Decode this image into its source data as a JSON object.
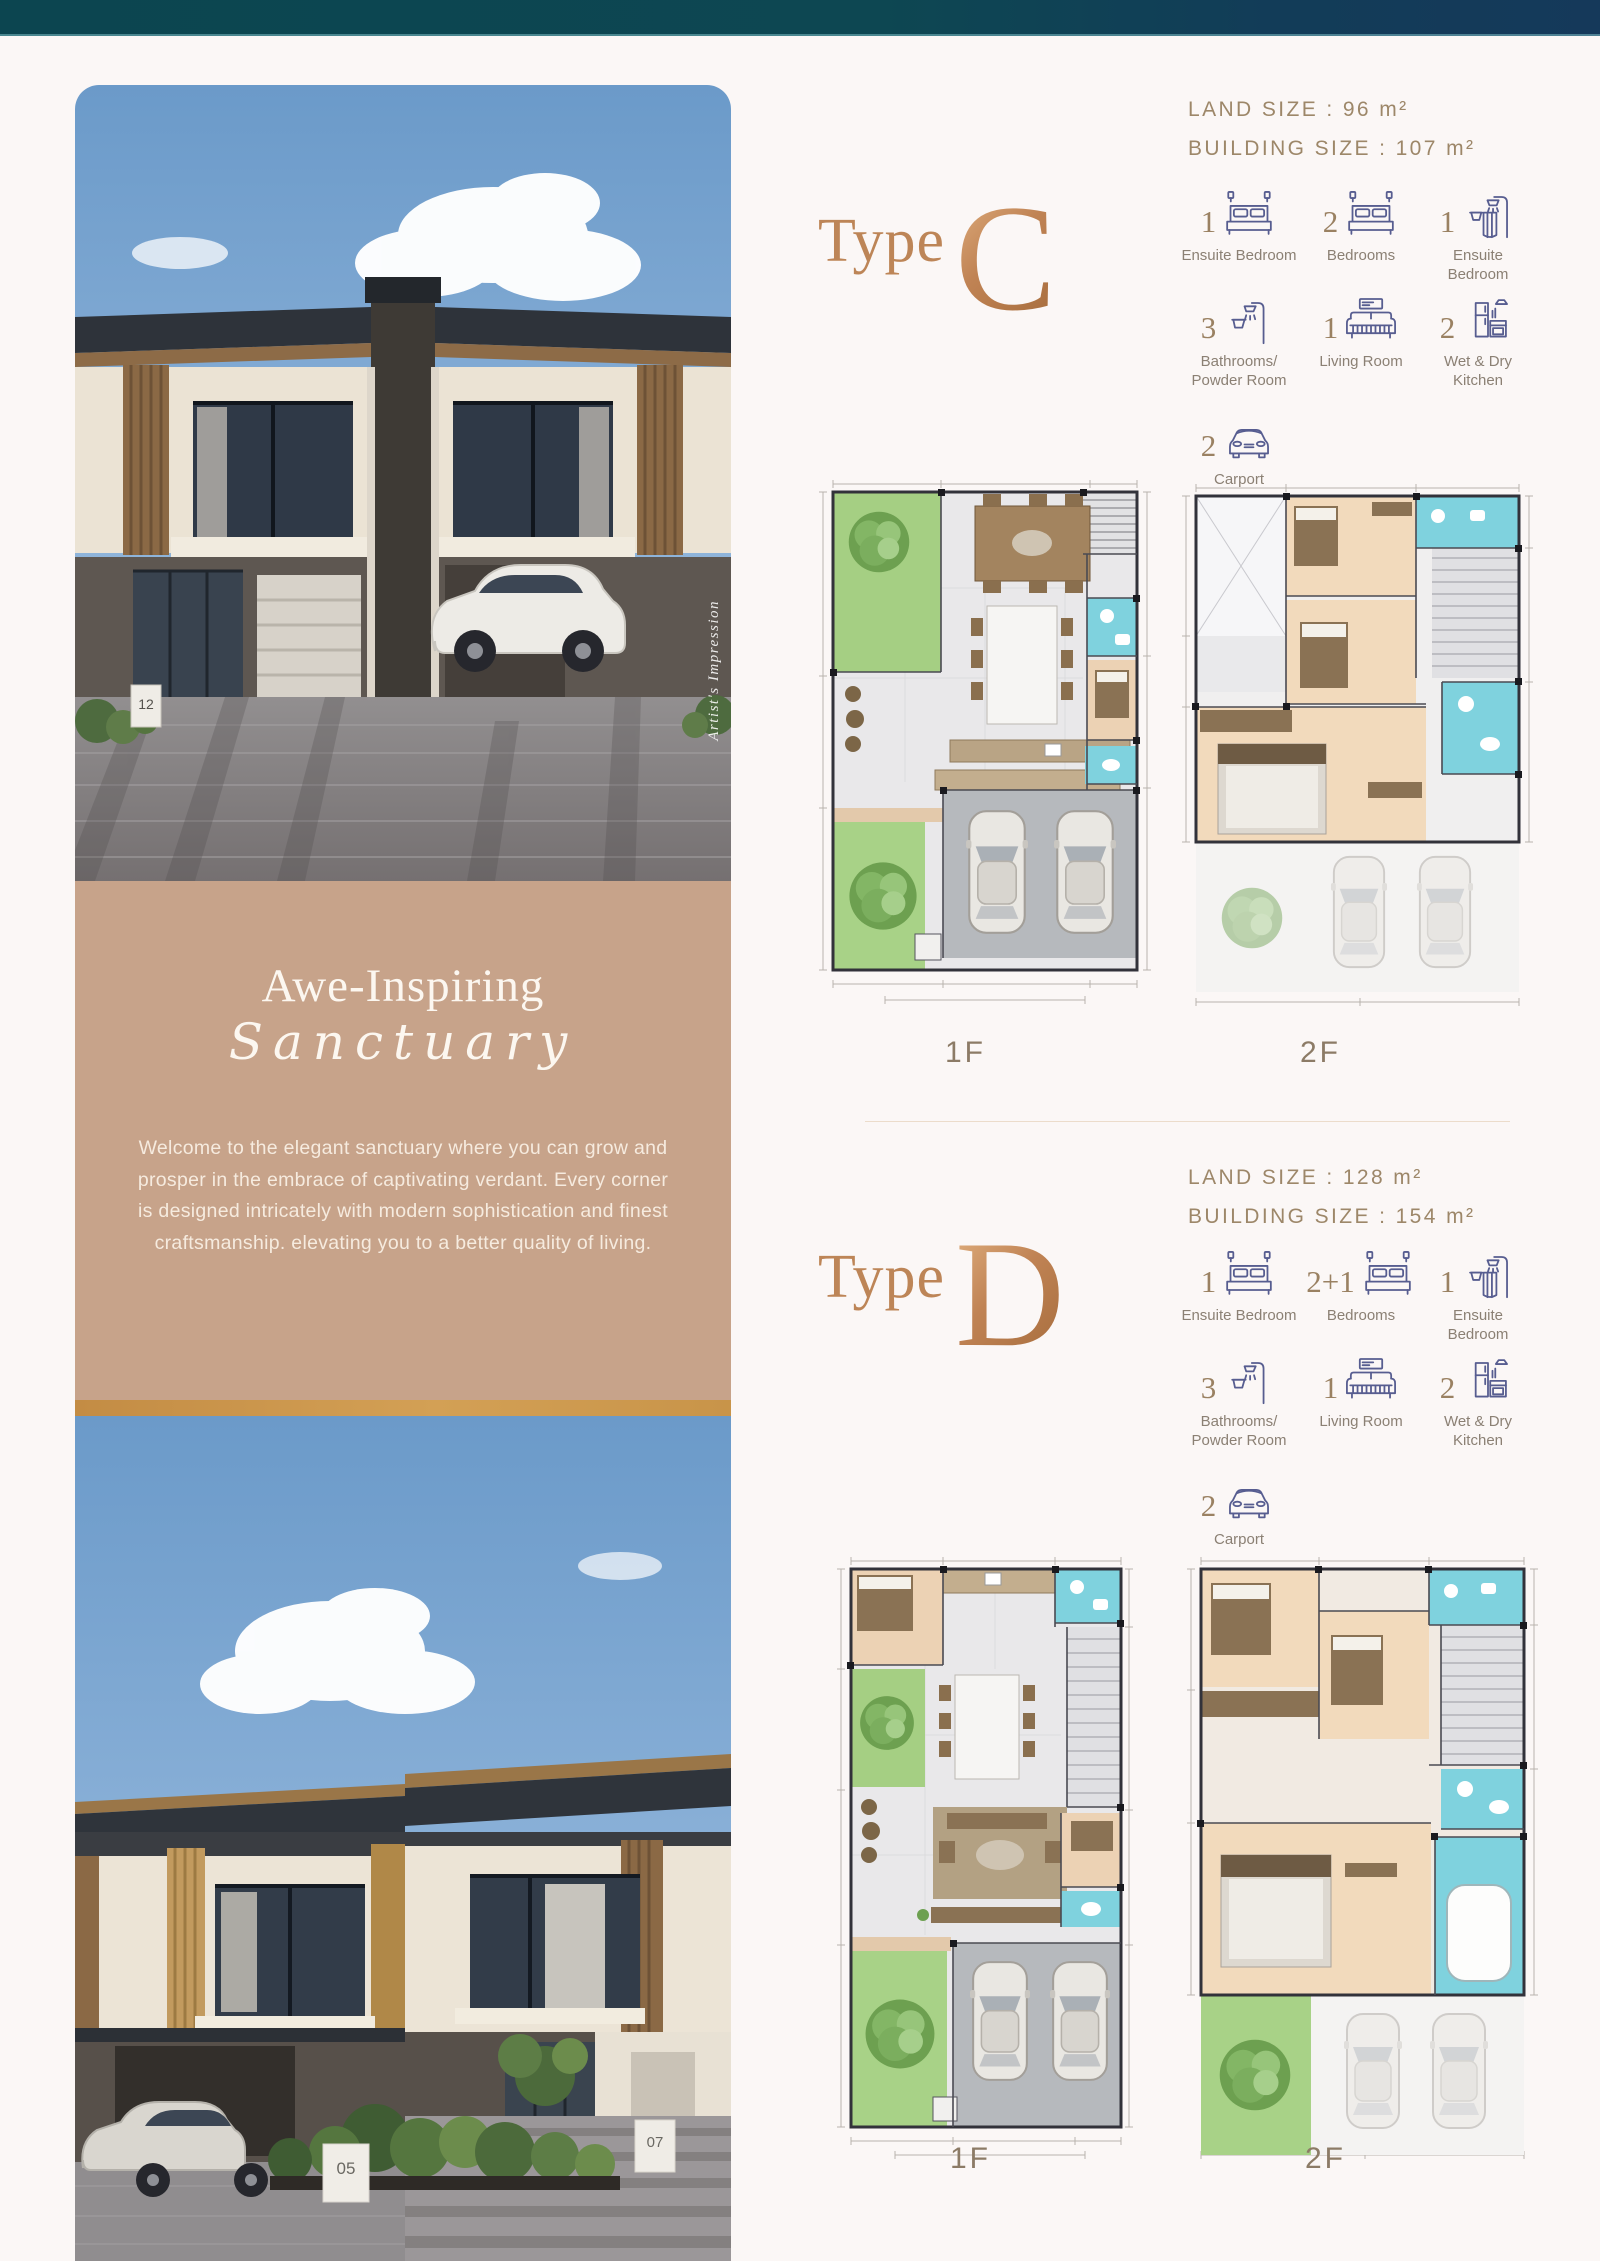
{
  "colors": {
    "top_bar_teal": "#0c4550",
    "top_bar_navy": "#15395a",
    "tan_panel": "#c7a38a",
    "copper_accent": "#c08354",
    "spec_text_taupe": "#9d8769",
    "icon_navy": "#575d90",
    "plan_bathroom_cyan": "#7fd2de",
    "plan_garden_green": "#a5cf83"
  },
  "photos": {
    "artists_impression": "Artist's Impression",
    "top_house_sign": "12",
    "bottom_house_sign_left": "05",
    "bottom_house_sign_right": "07"
  },
  "sanctuary": {
    "title": "Awe-Inspiring",
    "subtitle": "Sanctuary",
    "description": "Welcome to the elegant sanctuary where you can grow and prosper in the embrace of captivating verdant. Every corner is designed intricately with modern sophistication and finest craftsmanship. elevating you to a better quality of living."
  },
  "type_c": {
    "word": "Type",
    "letter": "C",
    "land_size": "LAND SIZE : 96 m²",
    "building_size": "BUILDING SIZE : 107 m²",
    "features": [
      {
        "count": "1",
        "label": "Ensuite Bedroom",
        "icon": "bed-icon"
      },
      {
        "count": "2",
        "label": "Bedrooms",
        "icon": "bed-icon"
      },
      {
        "count": "1",
        "label": "Ensuite Bedroom",
        "icon": "shower-curtain-icon"
      },
      {
        "count": "3",
        "label": "Bathrooms/ Powder Room",
        "icon": "shower-icon"
      },
      {
        "count": "1",
        "label": "Living Room",
        "icon": "sofa-icon"
      },
      {
        "count": "2",
        "label": "Wet & Dry Kitchen",
        "icon": "kitchen-icon"
      },
      {
        "count": "2",
        "label": "Carport",
        "icon": "car-icon"
      }
    ],
    "floors": [
      "1F",
      "2F"
    ]
  },
  "type_d": {
    "word": "Type",
    "letter": "D",
    "land_size": "LAND SIZE : 128 m²",
    "building_size": "BUILDING SIZE : 154 m²",
    "features": [
      {
        "count": "1",
        "label": "Ensuite Bedroom",
        "icon": "bed-icon"
      },
      {
        "count": "2+1",
        "label": "Bedrooms",
        "icon": "bed-icon"
      },
      {
        "count": "1",
        "label": "Ensuite Bedroom",
        "icon": "shower-curtain-icon"
      },
      {
        "count": "3",
        "label": "Bathrooms/ Powder Room",
        "icon": "shower-icon"
      },
      {
        "count": "1",
        "label": "Living Room",
        "icon": "sofa-icon"
      },
      {
        "count": "2",
        "label": "Wet & Dry Kitchen",
        "icon": "kitchen-icon"
      },
      {
        "count": "2",
        "label": "Carport",
        "icon": "car-icon"
      }
    ],
    "floors": [
      "1F",
      "2F"
    ]
  }
}
